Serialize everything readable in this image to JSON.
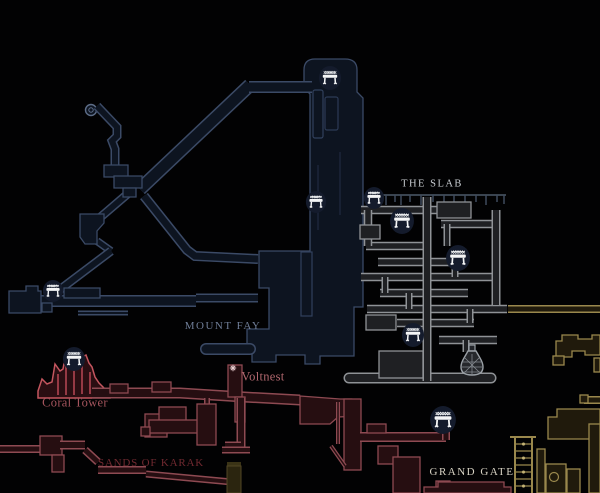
{
  "map": {
    "labels": {
      "the_slab": "THE SLAB",
      "mount_fay": "MOUNT FAY",
      "coral_tower": "Coral Tower",
      "voltnest": "Voltnest",
      "sands_of_karak": "SANDS OF KARAK",
      "grand_gate": "GRAND GATE"
    },
    "label_colors": {
      "the_slab": "#c9cdd2",
      "mount_fay": "#6f7d97",
      "coral_tower": "#a6555e",
      "voltnest": "#b2686f",
      "sands_of_karak": "#702930",
      "grand_gate": "#d8d3c4"
    },
    "region_colors": {
      "mount_fay": {
        "outline": "#3b4a66",
        "fill": "#0d1420"
      },
      "the_slab": {
        "outline": "#8f9296",
        "fill": "#1f2023"
      },
      "sands_of_karak": {
        "outline": "#8e4a52",
        "fill": "#260e11"
      },
      "grand_gate": {
        "outline": "#9a884d",
        "fill": "#201a0c"
      }
    },
    "accent_colors": {
      "coral_tower_outline": "#c4565f",
      "bench_circle": "#141b2c",
      "bench_glyph": "#f4f5f6",
      "background": "#020203"
    },
    "bench_markers": [
      {
        "x": 330,
        "y": 78,
        "r": 12
      },
      {
        "x": 316,
        "y": 202,
        "r": 11
      },
      {
        "x": 374,
        "y": 198,
        "r": 11
      },
      {
        "x": 402,
        "y": 221,
        "r": 13
      },
      {
        "x": 458,
        "y": 258,
        "r": 13
      },
      {
        "x": 413,
        "y": 335,
        "r": 12
      },
      {
        "x": 443,
        "y": 420,
        "r": 14
      },
      {
        "x": 74,
        "y": 359,
        "r": 12
      },
      {
        "x": 53,
        "y": 291,
        "r": 11
      }
    ],
    "poi": {
      "caged_flask": {
        "x": 472,
        "y": 354
      },
      "volt_spark": {
        "x": 233,
        "y": 368
      }
    }
  }
}
